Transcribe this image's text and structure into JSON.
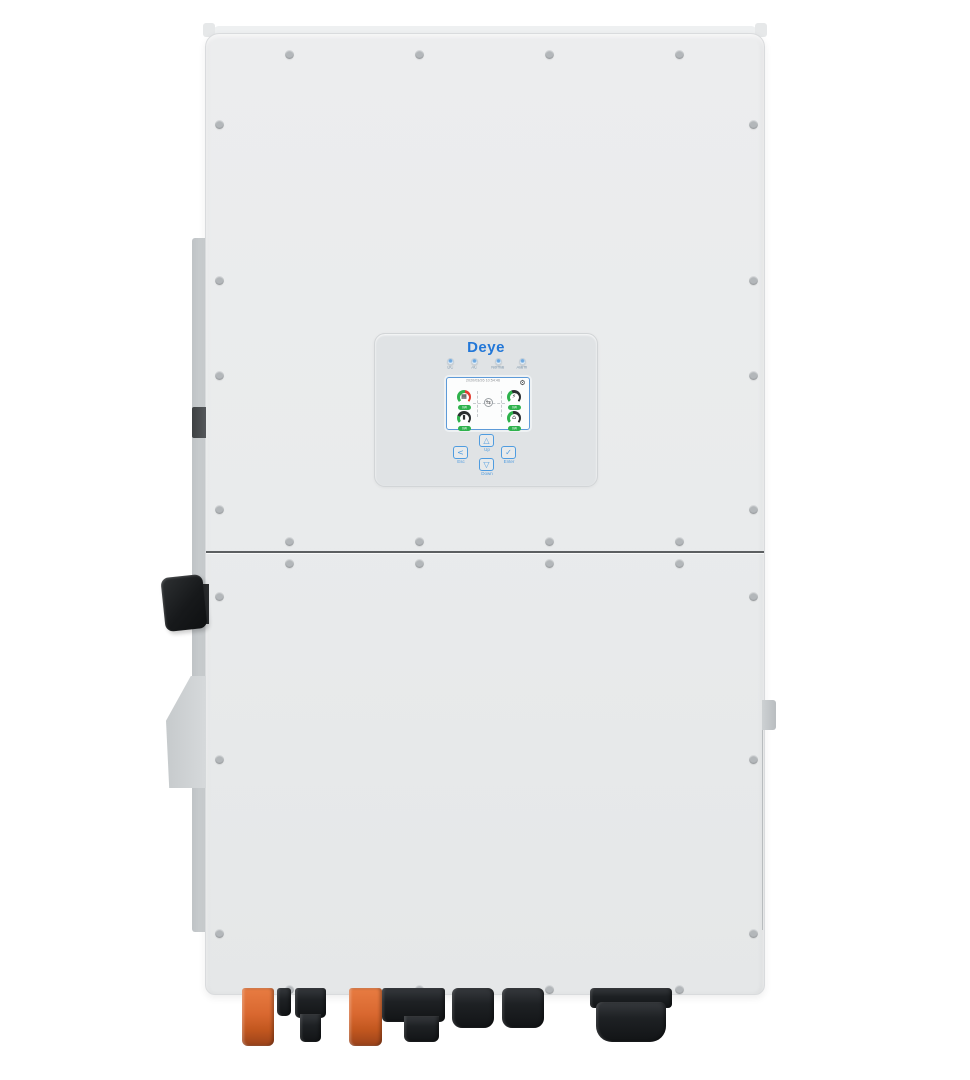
{
  "product": {
    "brand": "Deye",
    "description": "Three-phase hybrid solar inverter, front view"
  },
  "panel": {
    "logo": "Deye",
    "leds": [
      {
        "name": "dc-led",
        "label": "DC"
      },
      {
        "name": "ac-led",
        "label": "AC"
      },
      {
        "name": "normal-led",
        "label": "Normal"
      },
      {
        "name": "alarm-led",
        "label": "Alarm"
      }
    ],
    "screen": {
      "datetime": "2020/03/26 10:54:46",
      "gear_icon": "⚙",
      "center_icon": "⇆",
      "gauges": [
        {
          "name": "pv",
          "icon": "▦",
          "value": "0W",
          "arc_colors": [
            "#2eb24c",
            "#e23c30"
          ]
        },
        {
          "name": "grid",
          "icon": "⚡",
          "value": "0W",
          "arc_colors": [
            "#2eb24c",
            "#2b2e30"
          ]
        },
        {
          "name": "battery",
          "icon": "▮",
          "value": "0W",
          "arc_colors": [
            "#2eb24c",
            "#2b2e30"
          ]
        },
        {
          "name": "load",
          "icon": "⌂",
          "value": "0W",
          "arc_colors": [
            "#2eb24c",
            "#2b2e30"
          ]
        }
      ]
    },
    "buttons": [
      {
        "name": "esc",
        "glyph": "<",
        "label": "Esc"
      },
      {
        "name": "up",
        "glyph": "△",
        "label": "Up"
      },
      {
        "name": "down",
        "glyph": "▽",
        "label": "Down"
      },
      {
        "name": "enter",
        "glyph": "✓",
        "label": "Enter"
      }
    ]
  },
  "colors": {
    "body": "#e9ebec",
    "panel": "#e0e3e5",
    "brand_blue": "#2277d8",
    "button_blue": "#4f9ce0",
    "gauge_green": "#2eb24c",
    "gauge_red": "#e23c30",
    "connector_orange": "#d96830",
    "connector_black": "#1e2124"
  }
}
